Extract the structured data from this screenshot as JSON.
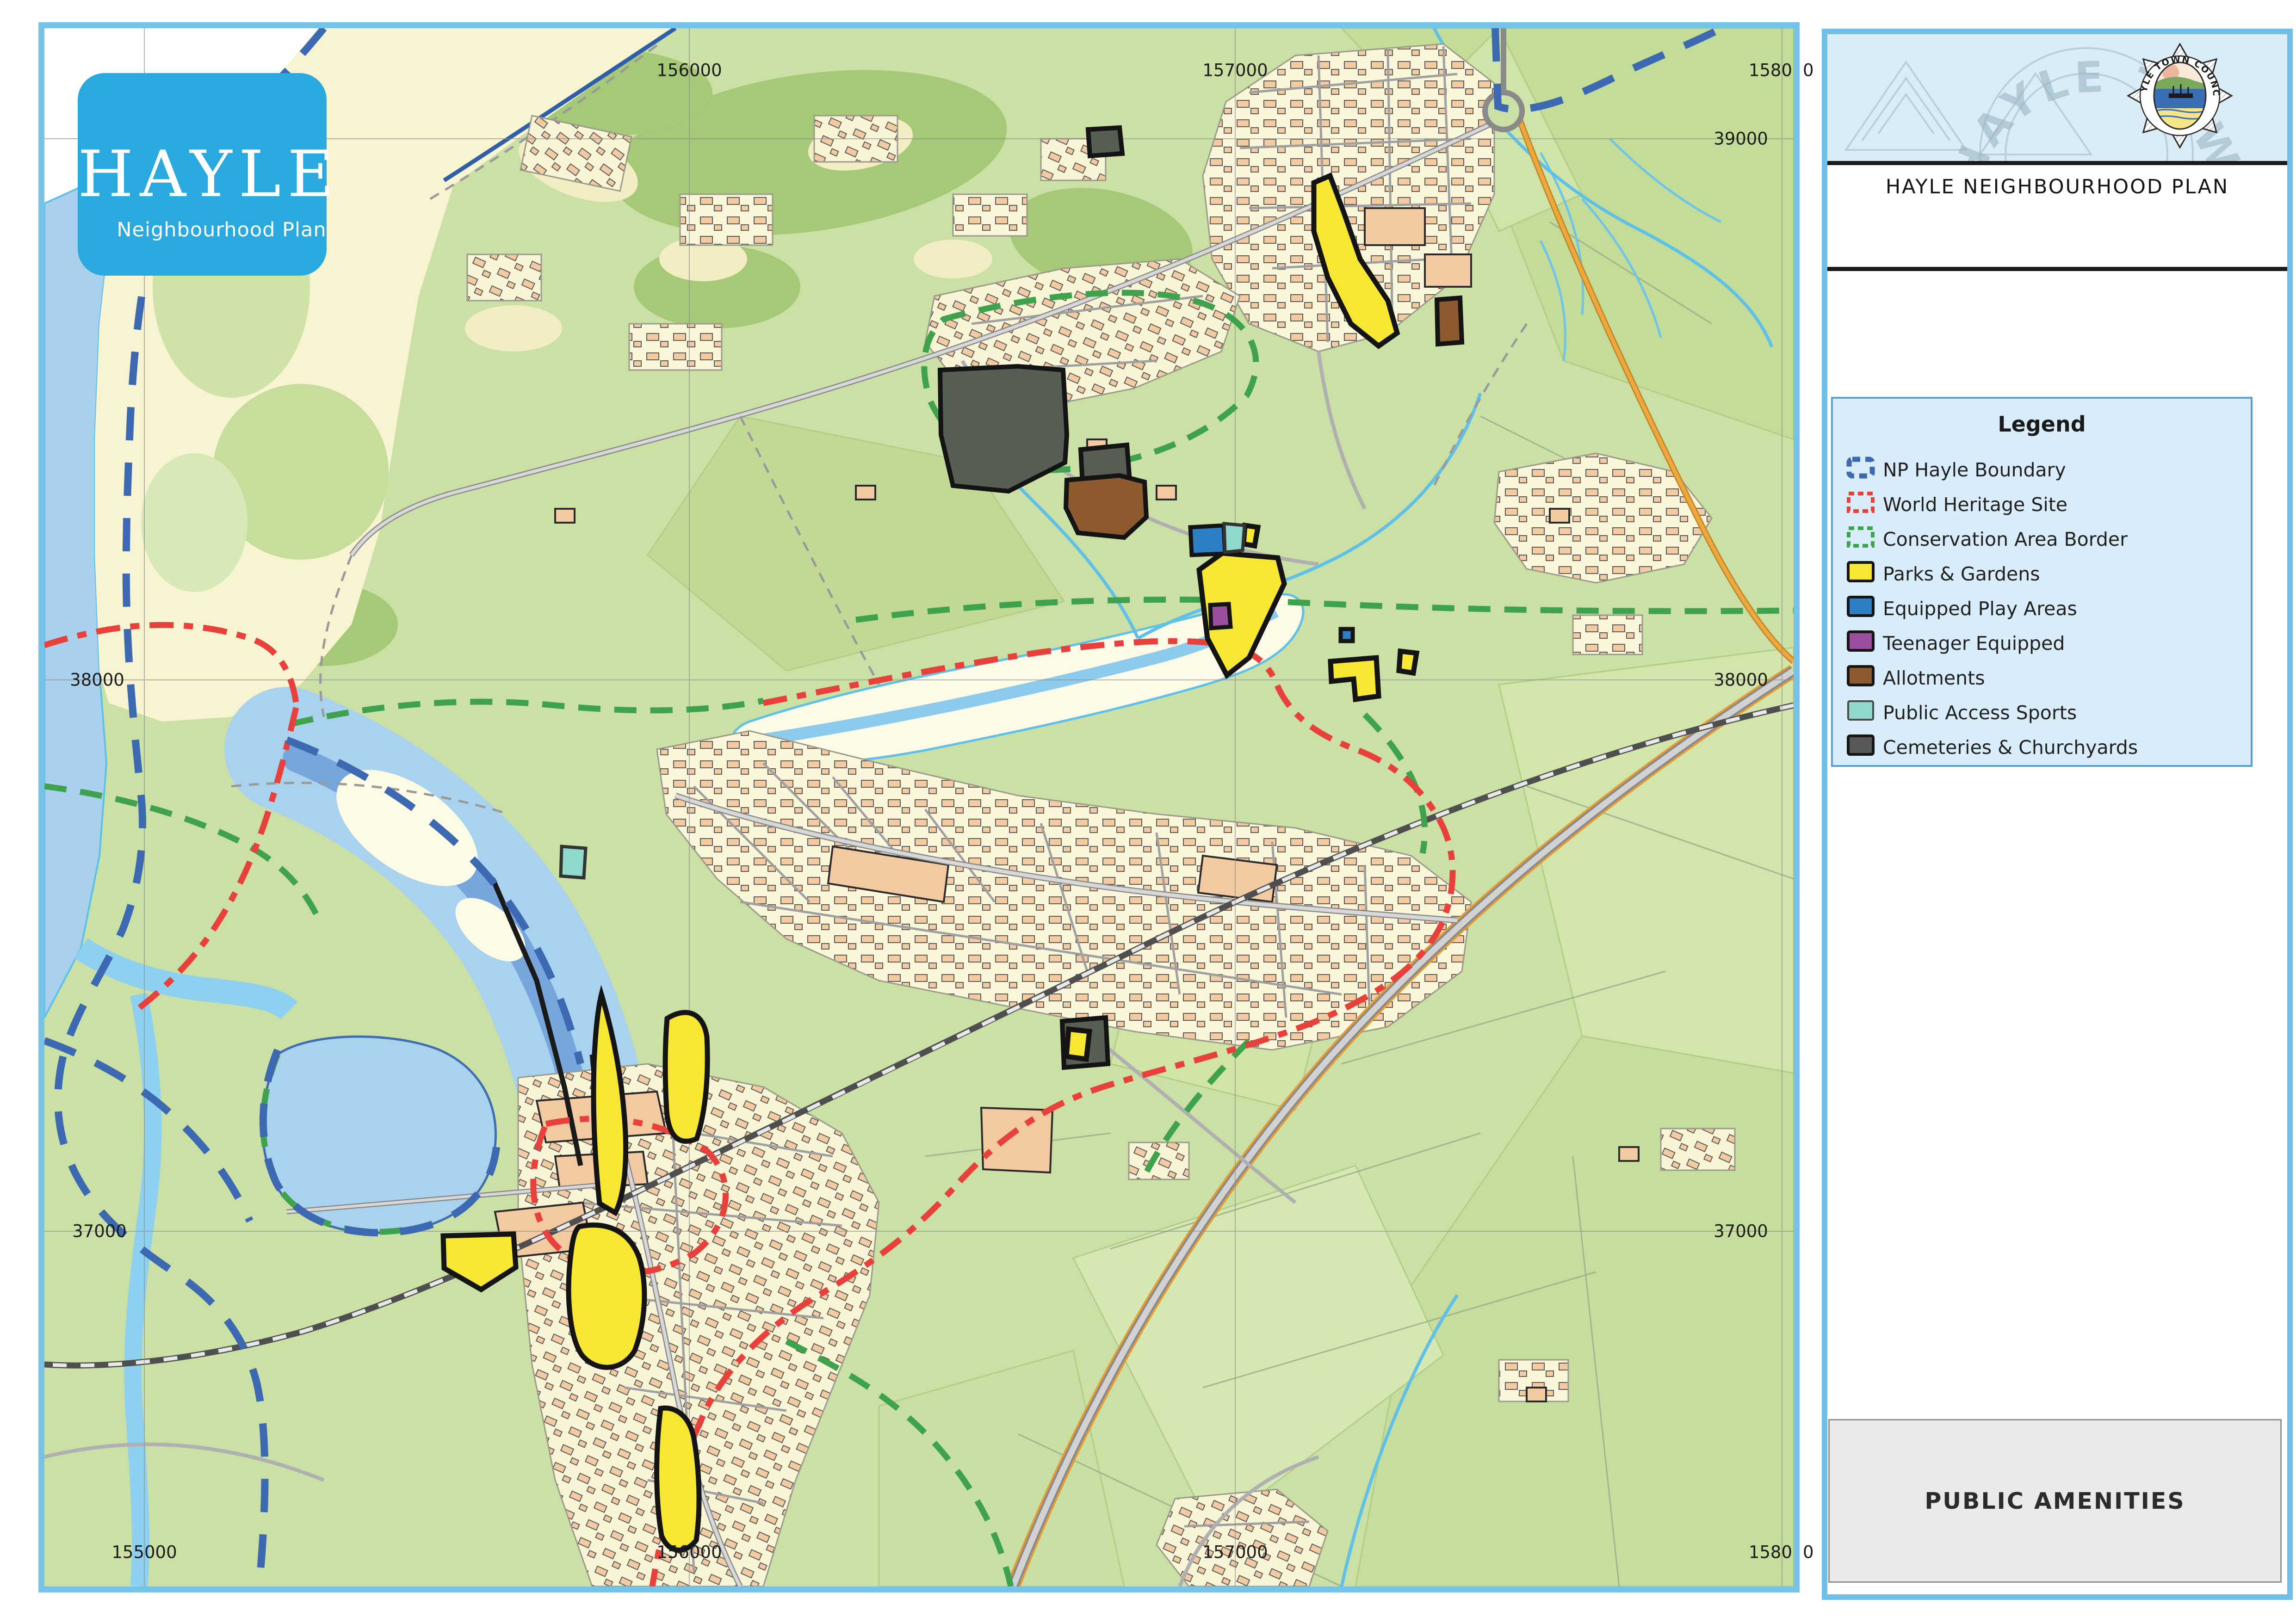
{
  "map_panel": {
    "logo": {
      "title": "HAYLE",
      "subtitle": "Neighbourhood Plan",
      "bg_color": "#29a9de"
    },
    "frame_color": "#74c2e8",
    "grid": {
      "top_labels": [
        "156000",
        "157000"
      ],
      "top_right_clip": {
        "inside": "1580",
        "outside": "0"
      },
      "bottom_labels": [
        "155000",
        "156000",
        "157000"
      ],
      "bottom_right_clip": {
        "inside": "1580",
        "outside": "0"
      },
      "left_labels": [
        "38000",
        "37000"
      ],
      "right_labels": [
        "39000",
        "38000",
        "37000"
      ]
    }
  },
  "sidebar": {
    "crest": {
      "ring_text": "HAYLE TOWN COUNCIL"
    },
    "title": "HAYLE NEIGHBOURHOOD PLAN",
    "legend": {
      "title": "Legend",
      "items": [
        {
          "label": "NP Hayle Boundary",
          "swatch": "dashed",
          "color": "#3c69b1",
          "border_width": "11",
          "dash": "17 11"
        },
        {
          "label": "World Heritage Site",
          "swatch": "dashed",
          "color": "#e8413c",
          "border_width": "8",
          "dash": "12 8"
        },
        {
          "label": "Conservation Area Border",
          "swatch": "dashed",
          "color": "#3ea34c",
          "border_width": "8",
          "dash": "12 8"
        },
        {
          "label": "Parks & Gardens",
          "swatch": "fill",
          "color": "#f7e733",
          "border": "#161616",
          "border_width": "6"
        },
        {
          "label": "Equipped Play Areas",
          "swatch": "fill",
          "color": "#2e7fc4",
          "border": "#161616",
          "border_width": "6"
        },
        {
          "label": "Teenager Equipped",
          "swatch": "fill",
          "color": "#9c4f9e",
          "border": "#161616",
          "border_width": "6"
        },
        {
          "label": "Allotments",
          "swatch": "fill",
          "color": "#8c5a2e",
          "border": "#161616",
          "border_width": "6"
        },
        {
          "label": "Public Access Sports",
          "swatch": "fill",
          "color": "#8fd8cc",
          "border": "#4a4a4a",
          "border_width": "4"
        },
        {
          "label": "Cemeteries & Churchyards",
          "swatch": "fill",
          "color": "#595959",
          "border": "#161616",
          "border_width": "6"
        }
      ]
    },
    "footer_title": "PUBLIC AMENITIES"
  }
}
